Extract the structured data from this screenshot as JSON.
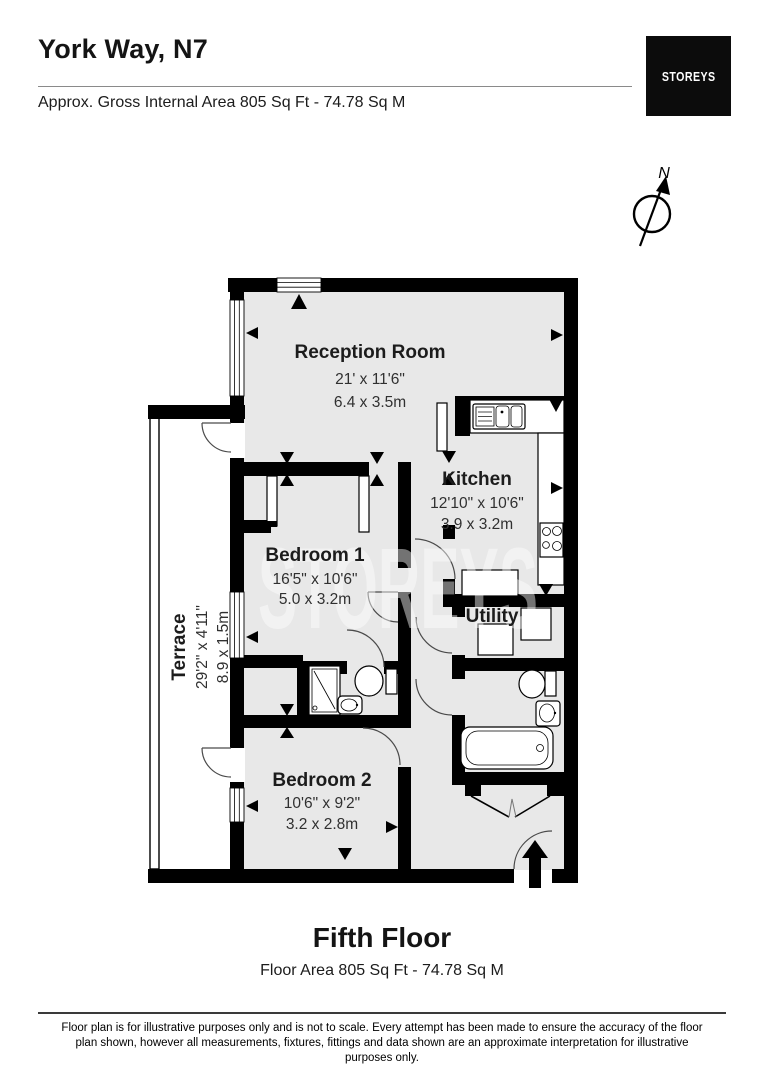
{
  "header": {
    "title": "York Way, N7",
    "subtitle": "Approx. Gross Internal Area 805 Sq Ft - 74.78 Sq M",
    "logo": "STOREYS"
  },
  "compass": {
    "north_label": "N"
  },
  "watermark": "STOREYS",
  "rooms": {
    "reception": {
      "name": "Reception Room",
      "imperial": "21' x 11'6\"",
      "metric": "6.4 x 3.5m"
    },
    "kitchen": {
      "name": "Kitchen",
      "imperial": "12'10\" x 10'6\"",
      "metric": "3.9 x 3.2m"
    },
    "bedroom1": {
      "name": "Bedroom 1",
      "imperial": "16'5\" x 10'6\"",
      "metric": "5.0 x 3.2m"
    },
    "bedroom2": {
      "name": "Bedroom 2",
      "imperial": "10'6\" x 9'2\"",
      "metric": "3.2 x 2.8m"
    },
    "utility": {
      "name": "Utility"
    },
    "terrace": {
      "name": "Terrace",
      "imperial": "29'2\" x 4'11\"",
      "metric": "8.9 x 1.5m"
    }
  },
  "floor": {
    "title": "Fifth Floor",
    "subtitle": "Floor Area 805 Sq Ft - 74.78 Sq M"
  },
  "footer": {
    "line1": "Floor plan is for illustrative purposes only and is not to scale. Every attempt has been made to ensure the accuracy of the floor",
    "line2": "plan shown, however all measurements, fixtures, fittings and data shown are an approximate interpretation for illustrative",
    "line3": "purposes only."
  },
  "colors": {
    "wall": "#000000",
    "floor_fill": "#e8e8e8",
    "logo_bg": "#0c0c0c"
  }
}
